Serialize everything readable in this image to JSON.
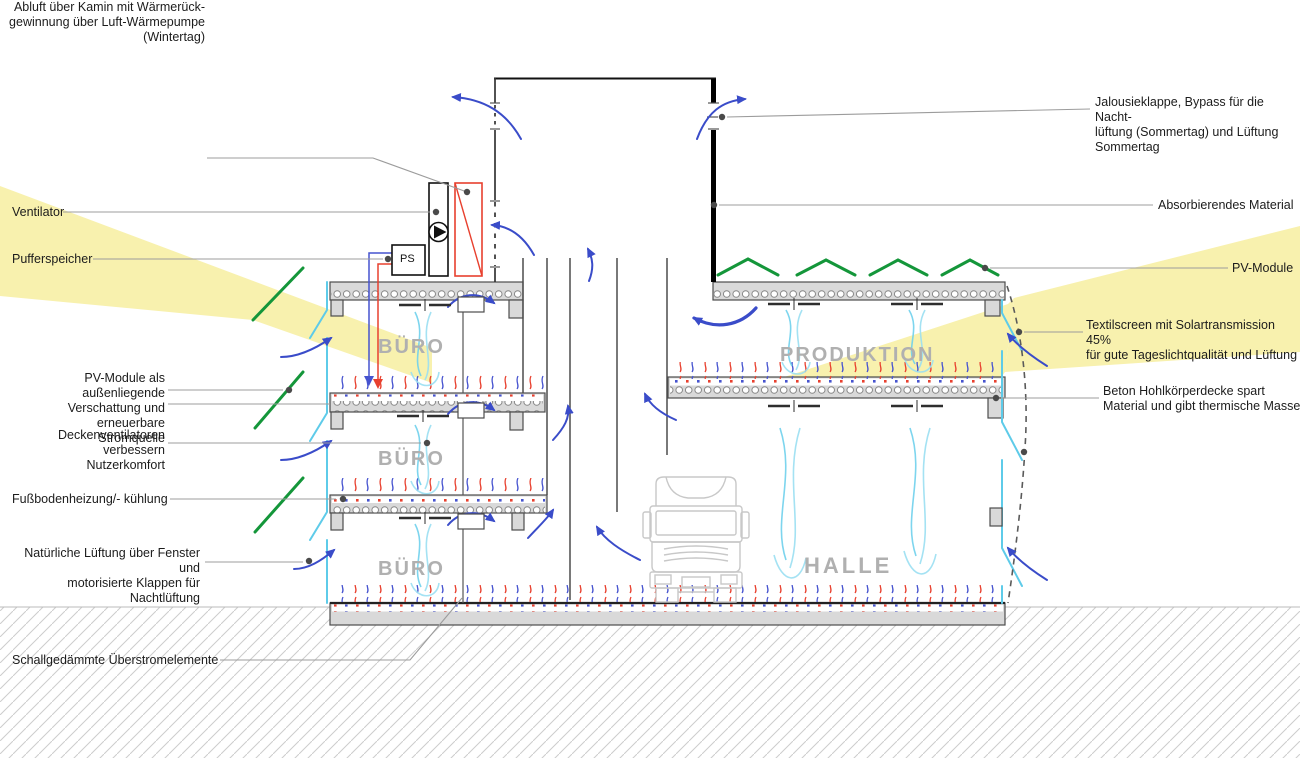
{
  "colors": {
    "sun": "#f8f1ae",
    "pv": "#14963a",
    "arrow": "#3a4cc9",
    "fresh": "#6fd0ec",
    "airlight": "#9adff2",
    "cyan": "#5ecbe9",
    "heat": "#e8402e",
    "cool": "#4653cf",
    "leader": "#9c9c9c",
    "structure": "#d9d9d9",
    "truck": "#c8c8c8",
    "absorber": "#000000"
  },
  "labels": {
    "left": [
      {
        "id": "abluft",
        "text": "Abluft über Kamin mit Wärmerück-\ngewinnung über Luft-Wärmepumpe\n(Wintertag)"
      },
      {
        "id": "ventilator",
        "text": "Ventilator"
      },
      {
        "id": "pufferspeicher",
        "text": "Pufferspeicher"
      },
      {
        "id": "pv-verschattung",
        "text": "PV-Module als außenliegende\nVerschattung und erneuerbare\nStromquelle"
      },
      {
        "id": "deckenventilatoren",
        "text": "Deckenventilatoren verbessern\nNutzerkomfort"
      },
      {
        "id": "fussbodenheizung",
        "text": "Fußbodenheizung/- kühlung"
      },
      {
        "id": "natuerliche-lueftung",
        "text": "Natürliche Lüftung über Fenster und\nmotorisierte Klappen für Nachtlüftung"
      },
      {
        "id": "schallgedaemmt",
        "text": "Schallgedämmte Überstromelemente"
      }
    ],
    "right": [
      {
        "id": "jalousieklappe",
        "text": "Jalousieklappe, Bypass für die Nacht-\nlüftung (Sommertag) und Lüftung\nSommertag"
      },
      {
        "id": "absorbierendes-material",
        "text": "Absorbierendes Material"
      },
      {
        "id": "pv-module",
        "text": "PV-Module"
      },
      {
        "id": "textilscreen",
        "text": "Textilscreen mit Solartransmission 45%\nfür gute Tageslichtqualität und Lüftung"
      },
      {
        "id": "beton-hohlkoerperdecke",
        "text": "Beton Hohlkörperdecke spart\nMaterial und gibt thermische Masse"
      }
    ]
  },
  "rooms": {
    "buero": "BÜRO",
    "produktion": "PRODUKTION",
    "halle": "HALLE"
  },
  "equipment": {
    "ps": "PS"
  }
}
